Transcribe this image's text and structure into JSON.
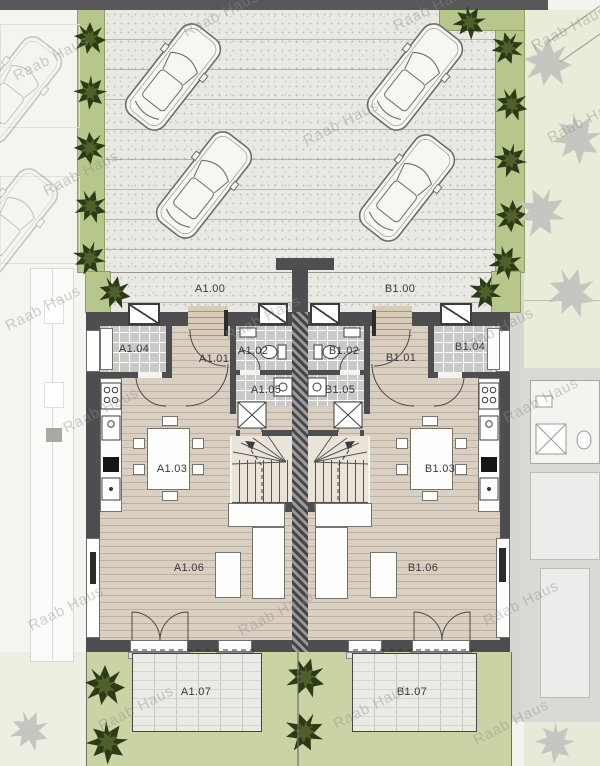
{
  "watermark": "Raab Haus",
  "labels": {
    "a1_00": "A1.00",
    "a1_01": "A1.01",
    "a1_02": "A1.02",
    "a1_03": "A1.03",
    "a1_04": "A1.04",
    "a1_05": "A1.05",
    "a1_06": "A1.06",
    "a1_07": "A1.07",
    "b1_00": "B1.00",
    "b1_01": "B1.01",
    "b1_02": "B1.02",
    "b1_03": "B1.03",
    "b1_04": "B1.04",
    "b1_05": "B1.05",
    "b1_06": "B1.06",
    "b1_07": "B1.07"
  },
  "colors": {
    "road_bar": "#58585a",
    "paving": "#e9e8e3",
    "planting_strip": "#b7c78b",
    "lawn": "#c9d3a4",
    "pale_lawn": "#e9ecd9",
    "wall": "#4e4e50",
    "wood_floor": "#d9cfc2",
    "tile_floor": "#c9cac7",
    "terrace": "#eceae5",
    "shrub_green": "#2d3a17",
    "watermark_gray": "#8e8e8b"
  },
  "icons": {
    "car": "car-top-view-icon",
    "shrub": "shrub-icon",
    "tree": "faint-tree-icon"
  }
}
